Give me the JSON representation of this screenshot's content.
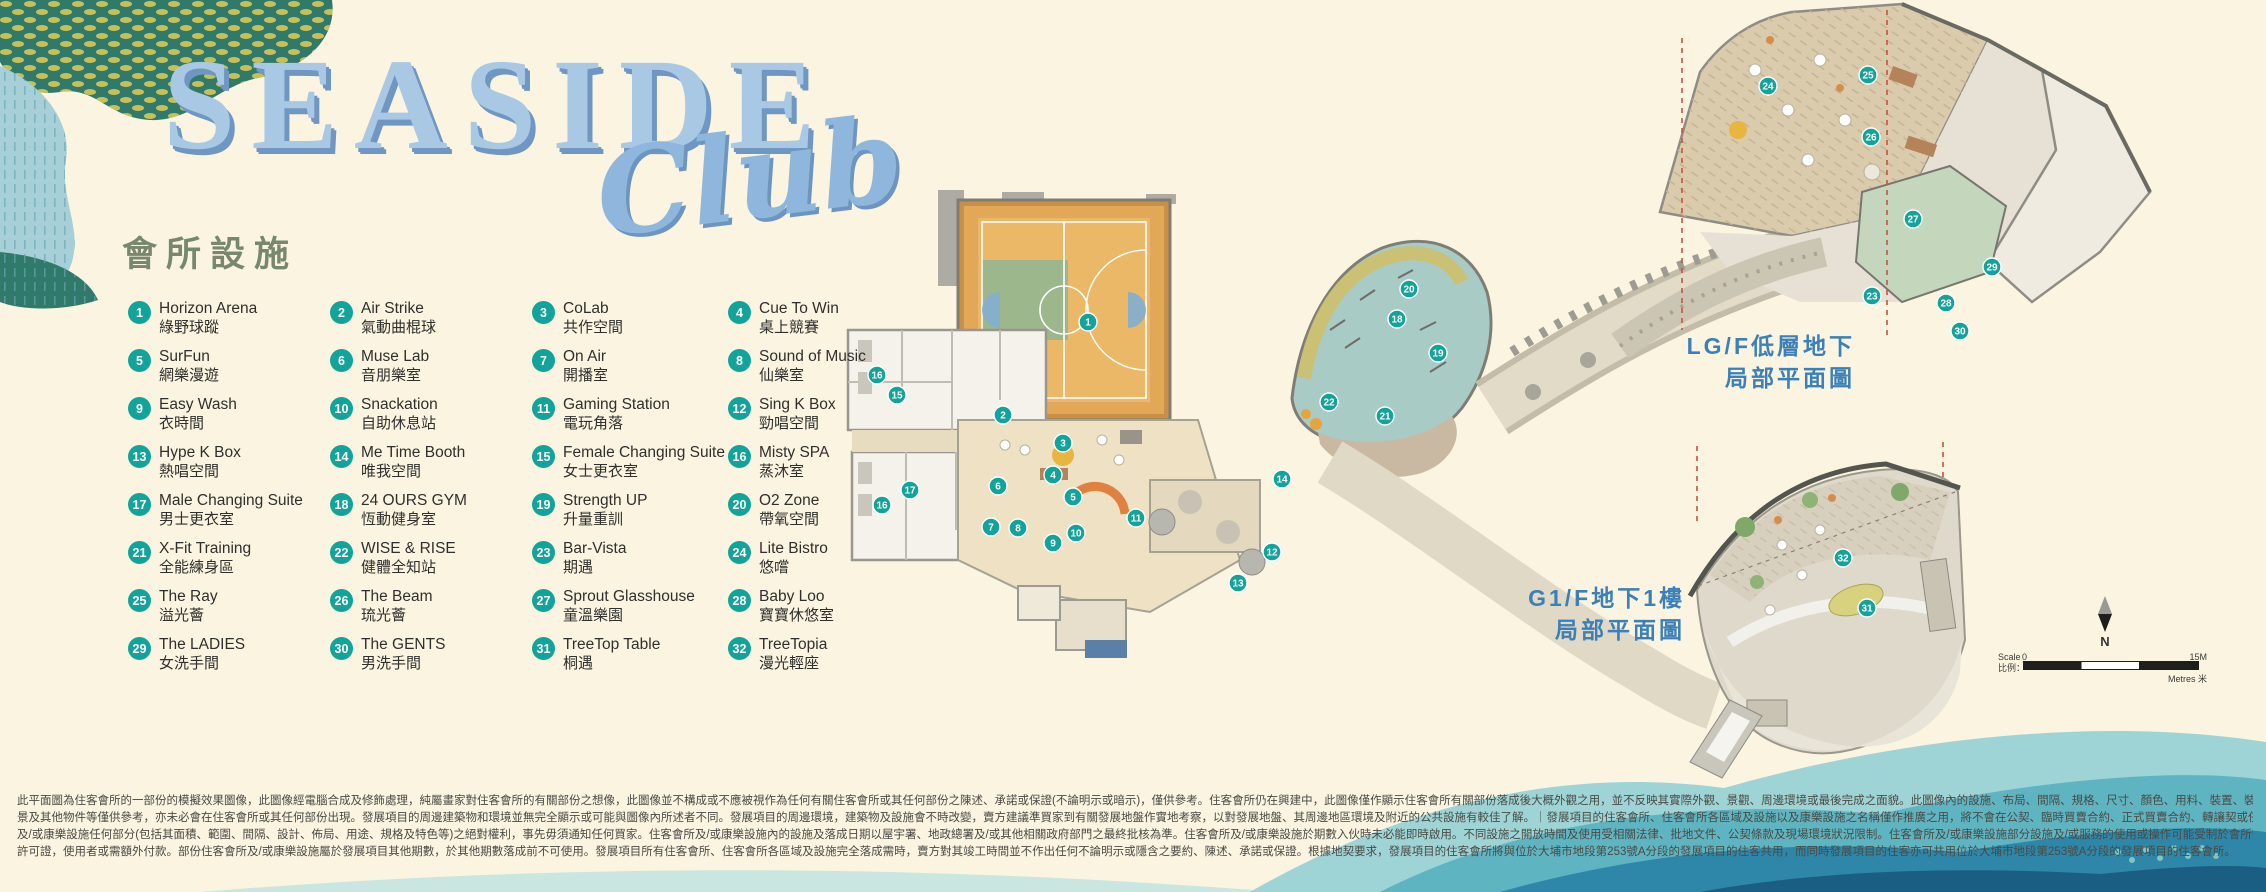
{
  "logo": {
    "title": "SEASIDE",
    "script": "Club",
    "subtitle": "會所設施"
  },
  "legend": {
    "items": [
      {
        "num": "1",
        "en": "Horizon Arena",
        "zh": "綠野球蹤"
      },
      {
        "num": "2",
        "en": "Air Strike",
        "zh": "氣動曲棍球"
      },
      {
        "num": "3",
        "en": "CoLab",
        "zh": "共作空間"
      },
      {
        "num": "4",
        "en": "Cue To Win",
        "zh": "桌上競賽"
      },
      {
        "num": "5",
        "en": "SurFun",
        "zh": "網樂漫遊"
      },
      {
        "num": "6",
        "en": "Muse Lab",
        "zh": "音朋樂室"
      },
      {
        "num": "7",
        "en": "On Air",
        "zh": "開播室"
      },
      {
        "num": "8",
        "en": "Sound of Music",
        "zh": "仙樂室"
      },
      {
        "num": "9",
        "en": "Easy Wash",
        "zh": "衣時間"
      },
      {
        "num": "10",
        "en": "Snackation",
        "zh": "自助休息站"
      },
      {
        "num": "11",
        "en": "Gaming Station",
        "zh": "電玩角落"
      },
      {
        "num": "12",
        "en": "Sing K Box",
        "zh": "勁唱空間"
      },
      {
        "num": "13",
        "en": "Hype K Box",
        "zh": "熱唱空間"
      },
      {
        "num": "14",
        "en": "Me Time Booth",
        "zh": "唯我空間"
      },
      {
        "num": "15",
        "en": "Female Changing Suite",
        "zh": "女士更衣室"
      },
      {
        "num": "16",
        "en": "Misty SPA",
        "zh": "蒸沐室"
      },
      {
        "num": "17",
        "en": "Male Changing Suite",
        "zh": "男士更衣室"
      },
      {
        "num": "18",
        "en": "24 OURS GYM",
        "zh": "恆動健身室"
      },
      {
        "num": "19",
        "en": "Strength UP",
        "zh": "升量重訓"
      },
      {
        "num": "20",
        "en": "O2 Zone",
        "zh": "帶氧空間"
      },
      {
        "num": "21",
        "en": "X-Fit Training",
        "zh": "全能練身區"
      },
      {
        "num": "22",
        "en": "WISE & RISE",
        "zh": "健體全知站"
      },
      {
        "num": "23",
        "en": "Bar-Vista",
        "zh": "期遇"
      },
      {
        "num": "24",
        "en": "Lite Bistro",
        "zh": "悠嚐"
      },
      {
        "num": "25",
        "en": "The Ray",
        "zh": "溢光薈"
      },
      {
        "num": "26",
        "en": "The Beam",
        "zh": "琉光薈"
      },
      {
        "num": "27",
        "en": "Sprout Glasshouse",
        "zh": "童溫樂園"
      },
      {
        "num": "28",
        "en": "Baby Loo",
        "zh": "寶寶休悠室"
      },
      {
        "num": "29",
        "en": "The LADIES",
        "zh": "女洗手間"
      },
      {
        "num": "30",
        "en": "The GENTS",
        "zh": "男洗手間"
      },
      {
        "num": "31",
        "en": "TreeTop Table",
        "zh": "桐遇"
      },
      {
        "num": "32",
        "en": "TreeTopia",
        "zh": "漫光輕座"
      }
    ]
  },
  "floor_labels": {
    "lgf": {
      "line1": "LG/F低層地下",
      "line2": "局部平面圖"
    },
    "g1f": {
      "line1": "G1/F地下1樓",
      "line2": "局部平面圖"
    }
  },
  "compass": {
    "north": "N"
  },
  "scale_bar": {
    "scale_en": "Scale",
    "scale_zh": "比例：",
    "zero": "0",
    "max": "15M",
    "unit": "Metres 米"
  },
  "markers": {
    "main": [
      {
        "n": "1",
        "x": 1088,
        "y": 322
      },
      {
        "n": "2",
        "x": 1003,
        "y": 415
      },
      {
        "n": "3",
        "x": 1063,
        "y": 443
      },
      {
        "n": "4",
        "x": 1053,
        "y": 475
      },
      {
        "n": "5",
        "x": 1073,
        "y": 497
      },
      {
        "n": "6",
        "x": 998,
        "y": 486
      },
      {
        "n": "7",
        "x": 991,
        "y": 527
      },
      {
        "n": "8",
        "x": 1018,
        "y": 528
      },
      {
        "n": "9",
        "x": 1053,
        "y": 543
      },
      {
        "n": "10",
        "x": 1076,
        "y": 533
      },
      {
        "n": "11",
        "x": 1136,
        "y": 518
      },
      {
        "n": "12",
        "x": 1272,
        "y": 552
      },
      {
        "n": "13",
        "x": 1238,
        "y": 583
      },
      {
        "n": "14",
        "x": 1282,
        "y": 479
      },
      {
        "n": "15",
        "x": 897,
        "y": 395
      },
      {
        "n": "16",
        "x": 877,
        "y": 375
      },
      {
        "n": "16",
        "x": 882,
        "y": 505
      },
      {
        "n": "17",
        "x": 910,
        "y": 490
      },
      {
        "n": "18",
        "x": 1397,
        "y": 319
      },
      {
        "n": "19",
        "x": 1438,
        "y": 353
      },
      {
        "n": "20",
        "x": 1409,
        "y": 289
      },
      {
        "n": "21",
        "x": 1385,
        "y": 416
      },
      {
        "n": "22",
        "x": 1329,
        "y": 402
      }
    ],
    "lgf": [
      {
        "n": "23",
        "x": 1872,
        "y": 296
      },
      {
        "n": "24",
        "x": 1768,
        "y": 86
      },
      {
        "n": "25",
        "x": 1868,
        "y": 75
      },
      {
        "n": "26",
        "x": 1871,
        "y": 137
      },
      {
        "n": "27",
        "x": 1913,
        "y": 219
      },
      {
        "n": "28",
        "x": 1946,
        "y": 303
      },
      {
        "n": "29",
        "x": 1992,
        "y": 267
      },
      {
        "n": "30",
        "x": 1960,
        "y": 331
      }
    ],
    "g1f": [
      {
        "n": "31",
        "x": 1867,
        "y": 608
      },
      {
        "n": "32",
        "x": 1843,
        "y": 558
      }
    ]
  },
  "colors": {
    "background": "#FAF4E1",
    "marker_teal": "#12A39A",
    "logo_blue": "#A9C8E4",
    "logo_shadow": "#7096C2",
    "floor_label_blue": "#3B80B9",
    "court_wood": "#E2A857",
    "court_green": "#9DB78D",
    "wave_dark": "#1B5E84"
  },
  "disclaimer": {
    "lines": [
      "此平面圖為住客會所的一部份的模擬效果圖像，此圖像經電腦合成及修飾處理，純屬畫家對住客會所的有關部份之想像，此圖像並不構成或不應被視作為任何有關住客會所或其任何部份之陳述、承諾或保證(不論明示或暗示)，僅供參考。住客會所仍在興建中，此圖像僅作顯示住客會所有關部份落成後大概外觀之用，並不反映其實際外觀、景觀、周邊環境或最後完成之面貌。此圖像內的設施、布局、間隔、規格、尺寸、顏色、用料、裝置、裝修物料、設備、燈光效果、傢俬、裝飾物、植物、園",
      "景及其他物件等僅供參考，亦未必會在住客會所或其任何部份出現。發展項目的周邊建築物和環境並無完全顯示或可能與圖像內所述者不同。發展項目的周邊環境，建築物及設施會不時改變，賣方建議準買家到有關發展地盤作實地考察，以對發展地盤、其周邊地區環境及附近的公共設施有較佳了解。｜發展項目的住客會所、住客會所各區域及設施以及康樂設施之名稱僅作推廣之用，將不會在公契、臨時買賣合約、正式買賣合約、轉讓契或任何其他業權契據中顯示。賣方保留一切修改住客會所",
      "及/或康樂設施任何部分(包括其面積、範圍、間隔、設計、佈局、用途、規格及特色等)之絕對權利，事先毋須通知任何買家。住客會所及/或康樂設施內的設施及落成日期以屋宇署、地政總署及/或其他相關政府部門之最終批核為準。住客會所及/或康樂設施於期數入伙時未必能即時啟用。不同設施之開放時間及使用受相關法律、批地文件、公契條款及現場環境狀況限制。住客會所及/或康樂設施部分設施及/或服務的使用或操作可能受制於會所守則及設施的使用守則及政府有關部門發出之同意書或",
      "許可證，使用者或需額外付款。部份住客會所及/或康樂設施屬於發展項目其他期數，於其他期數落成前不可使用。發展項目所有住客會所、住客會所各區域及設施完全落成需時，賣方對其竣工時間並不作出任何不論明示或隱含之要約、陳述、承諾或保證。根據地契要求，發展項目的住客會所將與位於大埔市地段第253號A分段的發展項目的住客共用，而同時發展項目的住客亦可共用位於大埔市地段第253號A分段的發展項目的住客會所。"
    ]
  }
}
